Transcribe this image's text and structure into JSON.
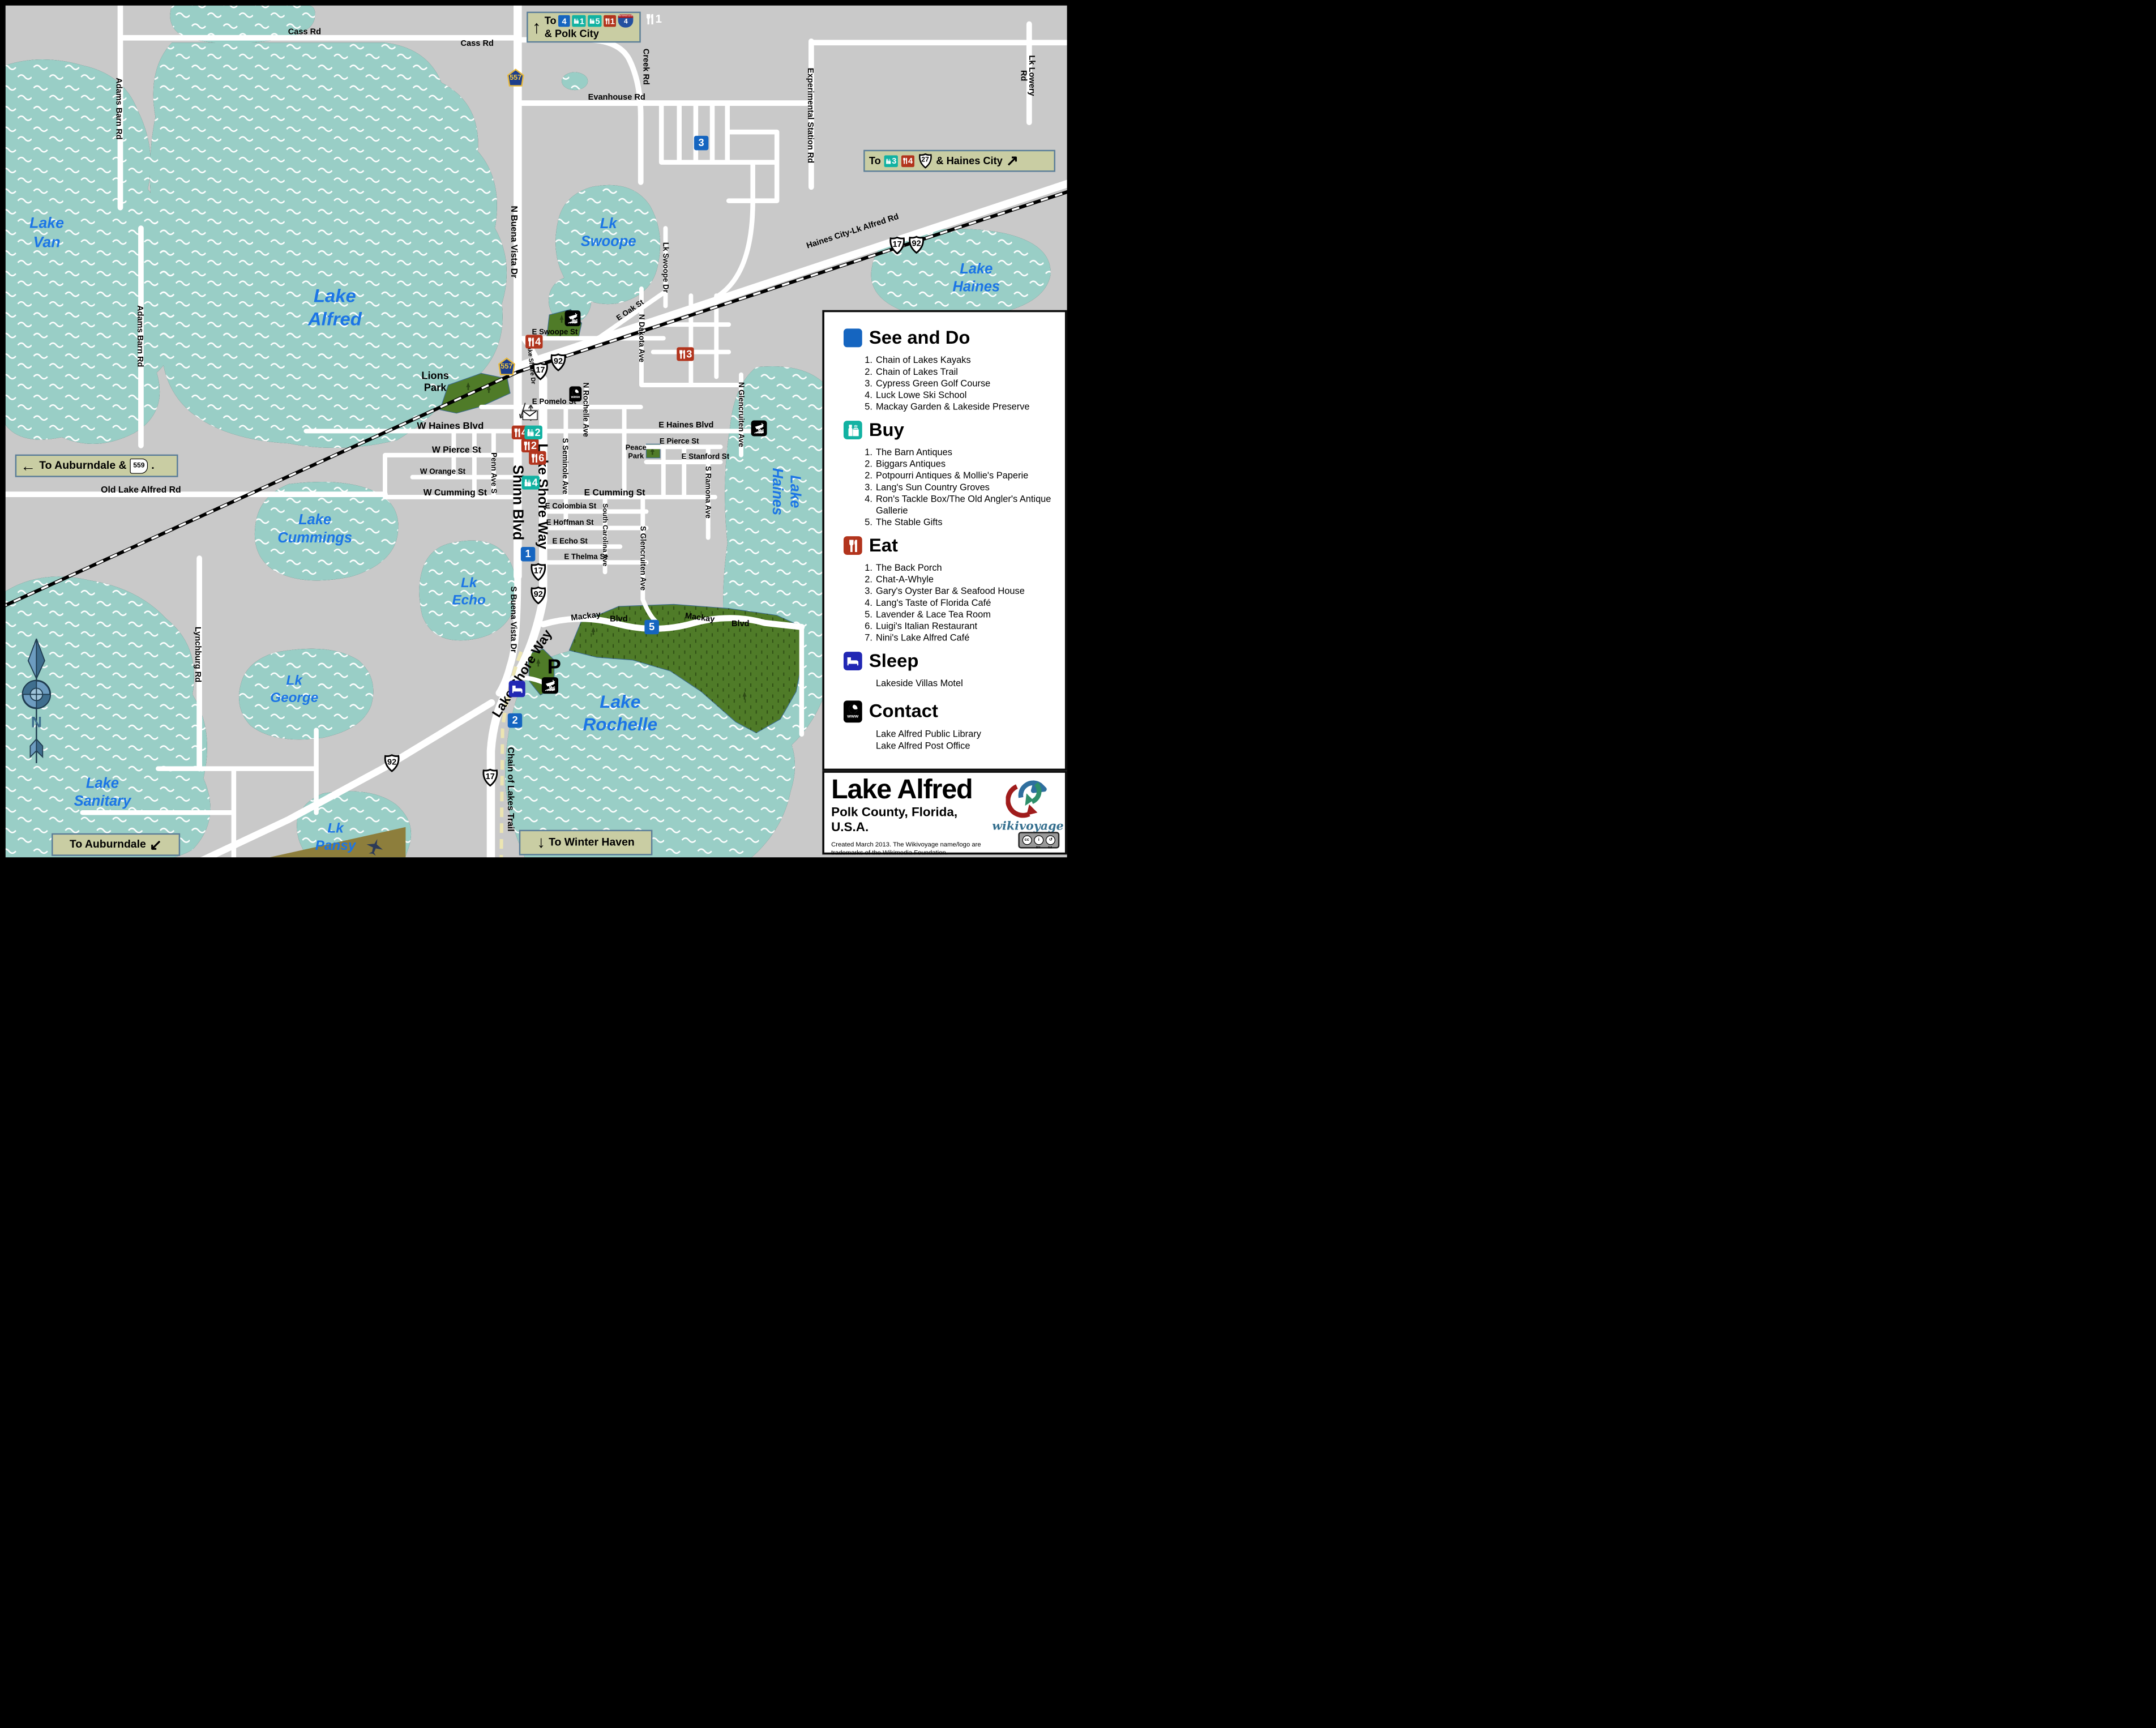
{
  "legend": {
    "see_do": {
      "title": "See and Do",
      "items": [
        {
          "num": "1.",
          "label": "Chain of Lakes Kayaks"
        },
        {
          "num": "2.",
          "label": "Chain of Lakes Trail"
        },
        {
          "num": "3.",
          "label": "Cypress Green Golf Course"
        },
        {
          "num": "4.",
          "label": "Luck Lowe Ski School"
        },
        {
          "num": "5.",
          "label": "Mackay Garden & Lakeside Preserve"
        }
      ]
    },
    "buy": {
      "title": "Buy",
      "items": [
        {
          "num": "1.",
          "label": "The Barn Antiques"
        },
        {
          "num": "2.",
          "label": "Biggars Antiques"
        },
        {
          "num": "2.",
          "label": "Potpourri Antiques & Mollie's Paperie"
        },
        {
          "num": "3.",
          "label": "Lang's Sun Country Groves"
        },
        {
          "num": "4.",
          "label": "Ron's Tackle Box/The Old Angler's Antique Gallerie"
        },
        {
          "num": "5.",
          "label": "The Stable Gifts"
        }
      ]
    },
    "eat": {
      "title": "Eat",
      "items": [
        {
          "num": "1.",
          "label": "The Back Porch"
        },
        {
          "num": "2.",
          "label": "Chat-A-Whyle"
        },
        {
          "num": "3.",
          "label": "Gary's Oyster Bar & Seafood House"
        },
        {
          "num": "4.",
          "label": "Lang's Taste of Florida Café"
        },
        {
          "num": "5.",
          "label": "Lavender & Lace Tea Room"
        },
        {
          "num": "6.",
          "label": "Luigi's Italian Restaurant"
        },
        {
          "num": "7.",
          "label": "Nini's Lake Alfred Café"
        }
      ]
    },
    "sleep": {
      "title": "Sleep",
      "items": [
        {
          "label": "Lakeside Villas Motel"
        }
      ]
    },
    "contact": {
      "title": "Contact",
      "items": [
        {
          "label": "Lake Alfred Public Library"
        },
        {
          "label": "Lake Alfred Post Office"
        }
      ]
    }
  },
  "title_block": {
    "title": "Lake Alfred",
    "subtitle": "Polk County, Florida, U.S.A.",
    "credit": "Created March 2013. The Wikivoyage name/logo are\ntrademarks of the Wikimedia Foundation.\nhttp://wikimediafoundation.org/wiki/Trademark_Policy",
    "brand": "wikivoyage",
    "cc": "cc",
    "cc_by": "BY",
    "cc_sa": "SA"
  },
  "signs": {
    "polk_city": {
      "arrow": "↑",
      "to": "To",
      "see_do": "4",
      "buy_a": "1",
      "buy_b": "5",
      "eat": "1",
      "interstate_label": "INTERSTATE",
      "interstate": "4",
      "dest": "& Polk City"
    },
    "haines_city": {
      "to": "To",
      "buy": "3",
      "eat": "4",
      "us": "27",
      "dest": "& Haines City",
      "arrow": "↗"
    },
    "auburndale_559": {
      "arrow": "←",
      "text": "To Auburndale &",
      "route": "559",
      "period": "."
    },
    "auburndale_sw": {
      "text": "To Auburndale",
      "arrow": "↙"
    },
    "winter_haven": {
      "arrow": "↓",
      "text": "To Winter Haven"
    }
  },
  "map": {
    "shields": {
      "us17": "17",
      "us92": "92",
      "s557": "557"
    },
    "north": "N",
    "parking": "P",
    "www": "www",
    "lakes": [
      "Lake\nVan",
      "Lake\nAlfred",
      "Lk\nSwoope",
      "Lake\nHaines",
      "Lake\nHaines",
      "Lake\nCummings",
      "Lk\nEcho",
      "Lk\nGeorge",
      "Lake\nSanitary",
      "Lk\nPansy",
      "Lake\nRochelle"
    ],
    "parks": [
      "Lions\nPark",
      "Peace\nPark"
    ],
    "roads": [
      "Cass Rd",
      "Cass Rd",
      "Evanhouse Rd",
      "Creek Rd",
      "Experimental Station Rd",
      "Lk Lowery Rd",
      "Adams Barn Rd",
      "Adams Barn Rd",
      "N Buena Vista Dr",
      "Haines City-Lk Alfred Rd",
      "Old Lake Alfred Rd",
      "Lynchburg Rd",
      "E Swoope St",
      "E Oak St",
      "N Lake Shore Dr",
      "E Pomelo St",
      "W Haines Blvd",
      "E Haines Blvd",
      "W Pierce St",
      "E Pierce St",
      "E Stanford St",
      "W Orange St",
      "W Cumming St",
      "E Cumming St",
      "E Colombia St",
      "E Hoffman St",
      "E Echo St",
      "E Thelma St",
      "Penn Ave S",
      "Shinn Blvd",
      "Lake Shore Way",
      "S Seminole Ave",
      "N Rochelle Ave",
      "South Carolina Ave",
      "S Glencruiten Ave",
      "S Ramona Ave",
      "N Glencruiten Ave",
      "N Dakota Ave",
      "Lk Swoope Dr",
      "S Buena Vista Dr",
      "Mackay",
      "Blvd",
      "Mackay",
      "Blvd",
      "Lake Shore Way",
      "Chain of Lakes Trail"
    ],
    "markers": [
      {
        "type": "see_do",
        "n": "3"
      },
      {
        "type": "see_do",
        "n": "1"
      },
      {
        "type": "see_do",
        "n": "2"
      },
      {
        "type": "see_do",
        "n": "5"
      },
      {
        "type": "eat",
        "n": "4"
      },
      {
        "type": "eat",
        "n": "3"
      },
      {
        "type": "eat",
        "n": "4"
      },
      {
        "type": "eat",
        "n": "2"
      },
      {
        "type": "eat",
        "n": "6"
      },
      {
        "type": "buy",
        "n": "2"
      },
      {
        "type": "buy",
        "n": "4"
      },
      {
        "type": "eat_ghost",
        "n": "1"
      }
    ]
  }
}
